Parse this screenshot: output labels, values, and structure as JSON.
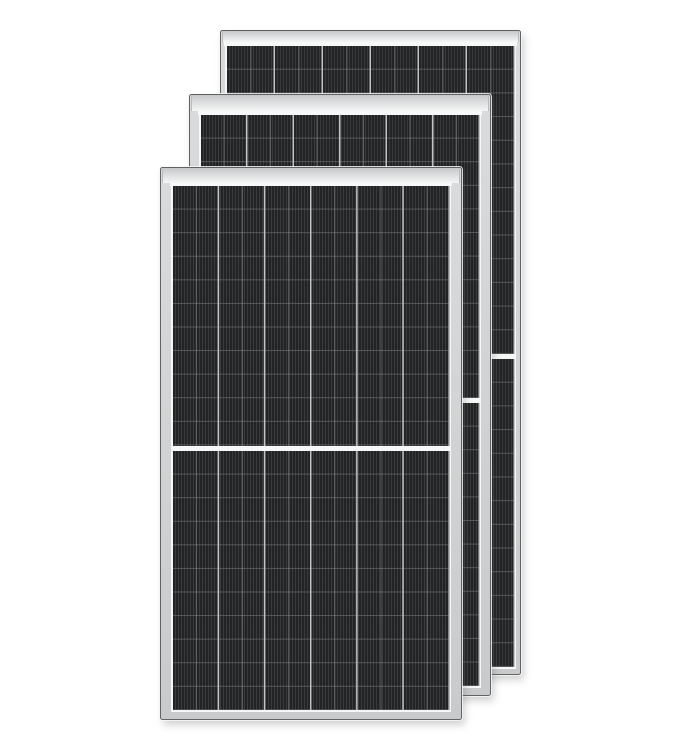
{
  "image": {
    "width": 684,
    "height": 748,
    "background": "#ffffff",
    "subject": "Three black monocrystalline half-cut solar panels with silver aluminum frames, stacked with diagonal offset"
  },
  "scene": {
    "colors": {
      "page_background": "#ffffff",
      "frame_face_light": "#d9dbdc",
      "frame_face_dark": "#c8cacb",
      "frame_rail_top": "#c5c7c8",
      "frame_rail_mid": "#e0e2e3",
      "frame_rail_bottom": "#f5f6f6",
      "frame_outline": "#606264",
      "frame_seam": "#b9bbbc",
      "outer_halo": "rgba(246,247,247,0.85)",
      "drop_shadow": "rgba(88,90,92,0.28)",
      "backsheet_white": "#f6f7f7",
      "glass_strip": "#f7f8f8",
      "cell_base": "#222324",
      "cell_stripe": "#3a3b3c",
      "column_divider": "#c2c4c5",
      "column_mid_line": "rgba(152,154,155,0.5)",
      "row_line": "rgba(125,127,129,0.55)"
    },
    "panels": [
      {
        "name": "back",
        "x": 220,
        "y": 30,
        "width": 301,
        "height": 645,
        "frame_side": 4,
        "frame_bottom": 5,
        "top_bar": 11,
        "white_strip": 4,
        "columns": 6,
        "rows_per_half": 13,
        "divider_height": 5
      },
      {
        "name": "middle",
        "x": 189,
        "y": 94,
        "width": 302,
        "height": 602,
        "frame_side": 9,
        "frame_bottom": 7,
        "top_bar": 16,
        "white_strip": 3.5,
        "columns": 6,
        "rows_per_half": 12,
        "divider_height": 5
      },
      {
        "name": "front",
        "x": 160,
        "y": 167,
        "width": 302,
        "height": 553,
        "frame_side": 10,
        "frame_bottom": 7,
        "top_bar": 15,
        "white_strip": 3,
        "columns": 6,
        "rows_per_half": 11,
        "divider_height": 5
      }
    ]
  }
}
